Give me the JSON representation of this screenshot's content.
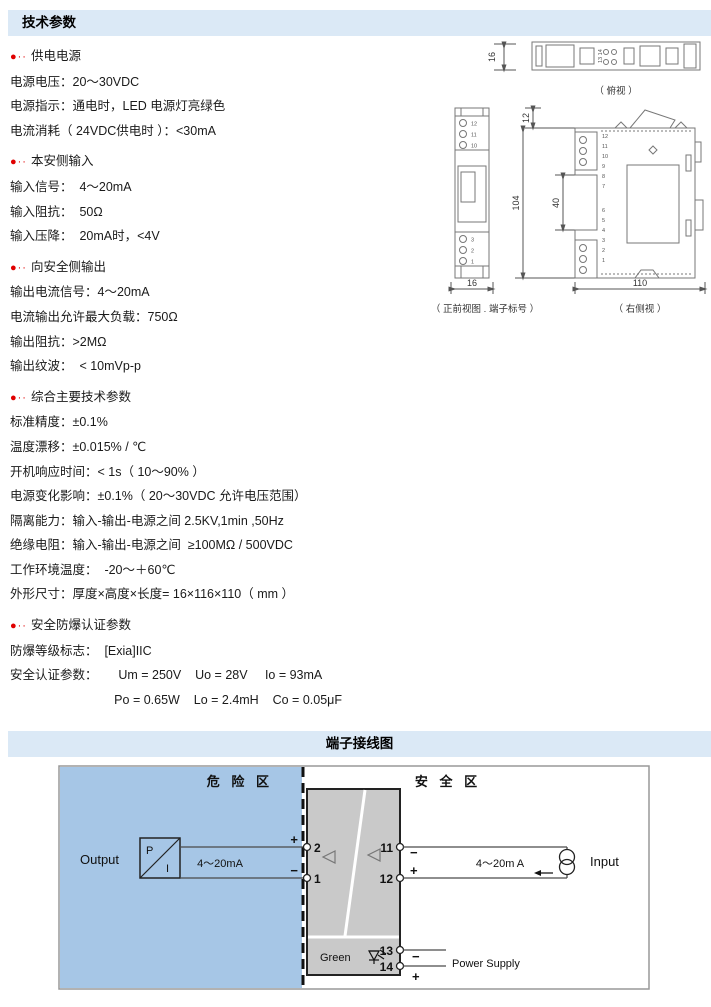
{
  "colors": {
    "header_bar": "#dbe9f6",
    "bullet_red": "#e00000",
    "hazard_blue": "#a6c6e6",
    "module_gray": "#c9c9c9"
  },
  "header_tech": {
    "title": "技术参数"
  },
  "header_wiring": {
    "title": "端子接线图"
  },
  "specs": {
    "bullet": "●··",
    "sections": [
      {
        "title": "供电电源",
        "lines": [
          "电源电压：20～30VDC",
          "电源指示：通电时，LED 电源灯亮绿色",
          "电流消耗（ 24VDC供电时 ）：<30mA"
        ]
      },
      {
        "title": "本安侧输入",
        "lines": [
          "输入信号：  4～20mA",
          "输入阻抗：  50Ω",
          "输入压降：  20mA时，<4V"
        ]
      },
      {
        "title": "向安全侧输出",
        "lines": [
          "输出电流信号：4～20mA",
          "电流输出允许最大负载：750Ω",
          "输出阻抗：>2MΩ",
          "输出纹波：  < 10mVp-p"
        ]
      },
      {
        "title": "综合主要技术参数",
        "lines": [
          "标准精度：±0.1%",
          "温度漂移：±0.015% / ℃",
          "开机响应时间：< 1s（ 10～90% ）",
          "电源变化影响：±0.1%（ 20～30VDC 允许电压范围）",
          "隔离能力：输入-输出-电源之间 2.5KV,1min ,50Hz",
          "绝缘电阻：输入-输出-电源之间  ≥100MΩ / 500VDC",
          "工作环境温度：  -20～＋60℃",
          "外形尺寸：厚度×高度×长度= 16×116×110（ mm ）"
        ]
      },
      {
        "title": "安全防爆认证参数",
        "lines": [
          "防爆等级标志：  [Exia]IIC",
          "安全认证参数：      Um = 250V    Uo = 28V     Io = 93mA",
          "                              Po = 0.65W    Lo = 2.4mH    Co = 0.05μF"
        ]
      }
    ]
  },
  "drawings": {
    "top_view": {
      "dim": "16",
      "terminals": "13 14",
      "caption": "（ 俯视 ）"
    },
    "front_view": {
      "dim": "16",
      "caption": "（ 正前视图 . 端子标号 ）",
      "top_terminals": [
        "12",
        "11",
        "10"
      ],
      "bottom_terminals": [
        "3",
        "2",
        "1"
      ]
    },
    "side_view": {
      "dim_top": "12",
      "dim_height": "104",
      "dim_mid": "40",
      "dim_length": "110",
      "caption": "（ 右侧视 ）",
      "top_terminals": [
        "12",
        "11",
        "10",
        "9",
        "8",
        "7"
      ],
      "bottom_terminals": [
        "6",
        "5",
        "4",
        "3",
        "2",
        "1"
      ]
    }
  },
  "wiring": {
    "hazard_label": "危 险 区",
    "safe_label": "安 全 区",
    "output_label": "Output",
    "input_label": "Input",
    "power_label": "Power Supply",
    "green_label": "Green",
    "pi_top": "P",
    "pi_bottom": "I",
    "output_signal": "4～20mA",
    "input_signal": "4～20m A",
    "plus": "+",
    "minus": "−",
    "terminals": {
      "t2": "2",
      "t1": "1",
      "t11": "11",
      "t12": "12",
      "t13": "13",
      "t14": "14"
    }
  }
}
